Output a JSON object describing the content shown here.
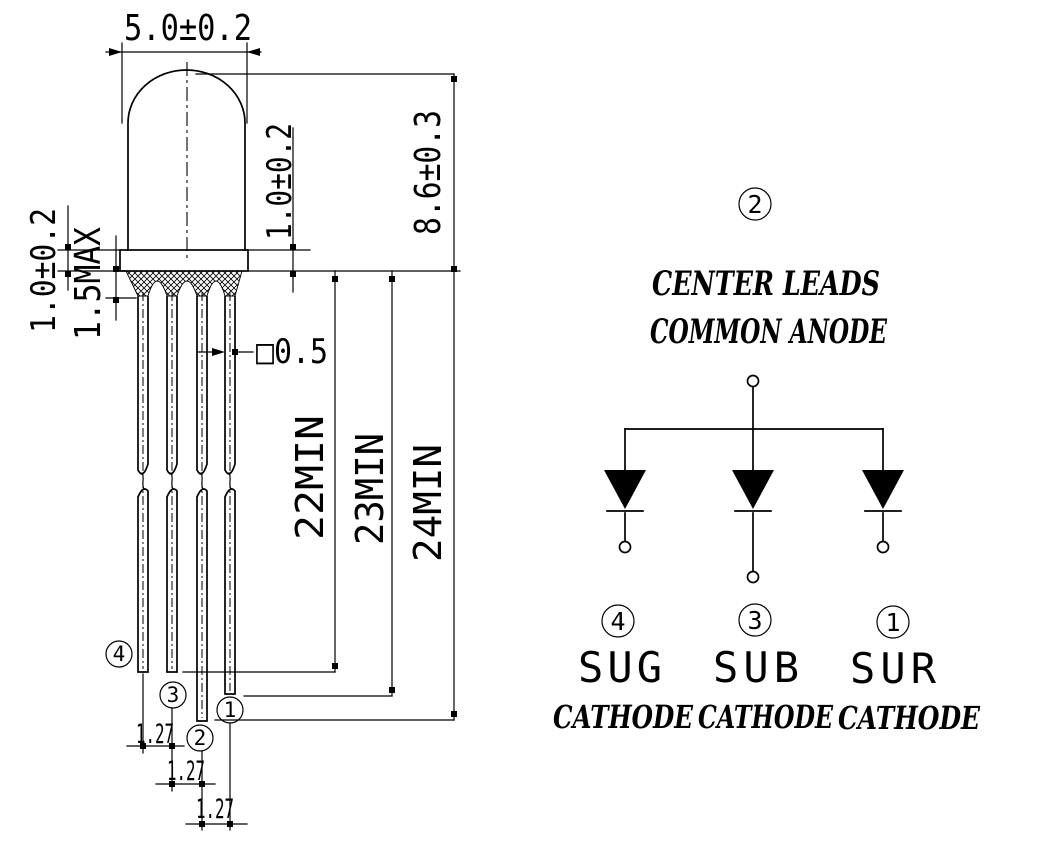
{
  "colors": {
    "ink": "#000000",
    "background": "#ffffff"
  },
  "package_drawing": {
    "lens_diameter": "5.0±0.2",
    "body_height": "8.6±0.3",
    "flange_thickness": "1.0±0.2",
    "flange_inner_dim": "1.0±0.2",
    "standoff_max": "1.5MAX",
    "lead_cross_section": "□0.5",
    "lead_length_short": "22MIN",
    "lead_length_mid": "23MIN",
    "lead_length_long": "24MIN",
    "lead_pitch_1": "1.27",
    "lead_pitch_2": "1.27",
    "lead_pitch_3": "1.27",
    "pin4": "4",
    "pin3": "3",
    "pin2": "2",
    "pin1": "1"
  },
  "schematic": {
    "top_pin_number": "2",
    "note_line1": "CENTER LEADS",
    "note_line2": "COMMON ANODE",
    "pins": [
      {
        "number": "4",
        "signal": "SUG",
        "terminal": "CATHODE"
      },
      {
        "number": "3",
        "signal": "SUB",
        "terminal": "CATHODE"
      },
      {
        "number": "1",
        "signal": "SUR",
        "terminal": "CATHODE"
      }
    ]
  }
}
